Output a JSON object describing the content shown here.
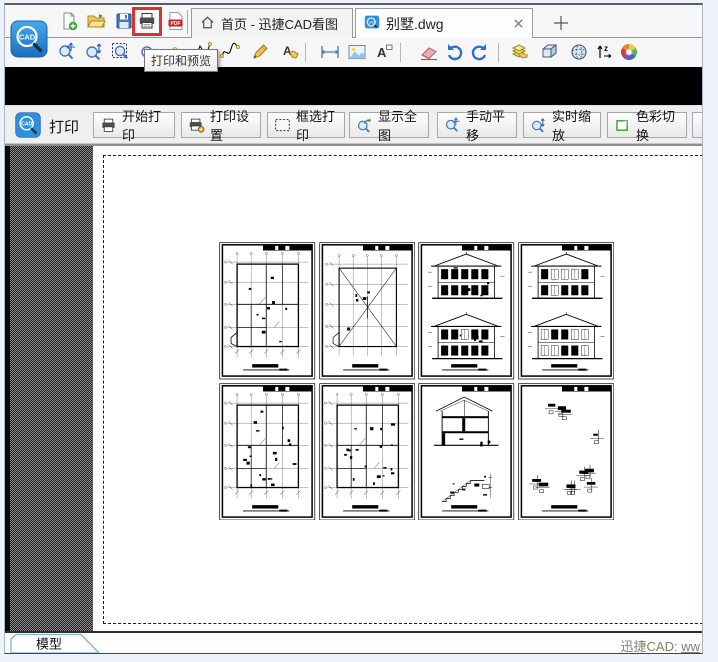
{
  "logo": {
    "text": "CAD"
  },
  "file_toolbar": {
    "icons": [
      "new-file-icon",
      "open-folder-icon",
      "save-icon",
      "print-icon",
      "pdf-export-icon"
    ],
    "pdf_label": "PDF"
  },
  "tabs": [
    {
      "label": "首页 - 迅捷CAD看图",
      "icon": "home-icon",
      "active": false
    },
    {
      "label": "别墅.dwg",
      "icon": "cad-file-icon",
      "active": true,
      "closable": true
    }
  ],
  "tooltip": {
    "text": "打印和预览"
  },
  "draw_toolbar": {
    "icons": [
      "pan-icon",
      "zoom-icon",
      "zoom-window-icon",
      "zoom-previous-icon",
      "arc-icon",
      "polyline-icon",
      "spline-icon",
      "pencil-icon",
      "annotate-icon",
      "measure-icon",
      "layout-icon",
      "text-icon",
      "eraser-icon",
      "undo-icon",
      "redo-icon",
      "layers-icon",
      "box-3d-icon",
      "orbit-3d-icon",
      "sort-icon",
      "color-wheel-icon"
    ]
  },
  "print_toolbar": {
    "title": "打印",
    "buttons": [
      {
        "label": "开始打印",
        "icon": "printer-icon"
      },
      {
        "label": "打印设置",
        "icon": "printer-settings-icon"
      },
      {
        "label": "框选打印",
        "icon": "marquee-icon"
      },
      {
        "label": "显示全图",
        "icon": "zoom-extents-icon"
      },
      {
        "label": "手动平移",
        "icon": "pan-icon"
      },
      {
        "label": "实时缩放",
        "icon": "zoom-realtime-icon"
      },
      {
        "label": "色彩切换",
        "icon": "color-switch-icon"
      },
      {
        "label": "",
        "icon": "back-view-icon"
      }
    ]
  },
  "canvas": {
    "sheets": [
      {
        "kind": "floor-plan"
      },
      {
        "kind": "roof-plan"
      },
      {
        "kind": "elevation-dense"
      },
      {
        "kind": "elevation-light"
      },
      {
        "kind": "floor-plan-2"
      },
      {
        "kind": "floor-plan-3"
      },
      {
        "kind": "section-stair"
      },
      {
        "kind": "details"
      }
    ]
  },
  "statusbar": {
    "model_tab": "模型",
    "brand": "迅捷CAD: ",
    "link": "ww"
  },
  "colors": {
    "highlight_red": "#d6342c",
    "logo_blue": "#2e8ee0",
    "tab_border": "#9a9a9a",
    "model_tab_border": "#7fb2d8"
  }
}
